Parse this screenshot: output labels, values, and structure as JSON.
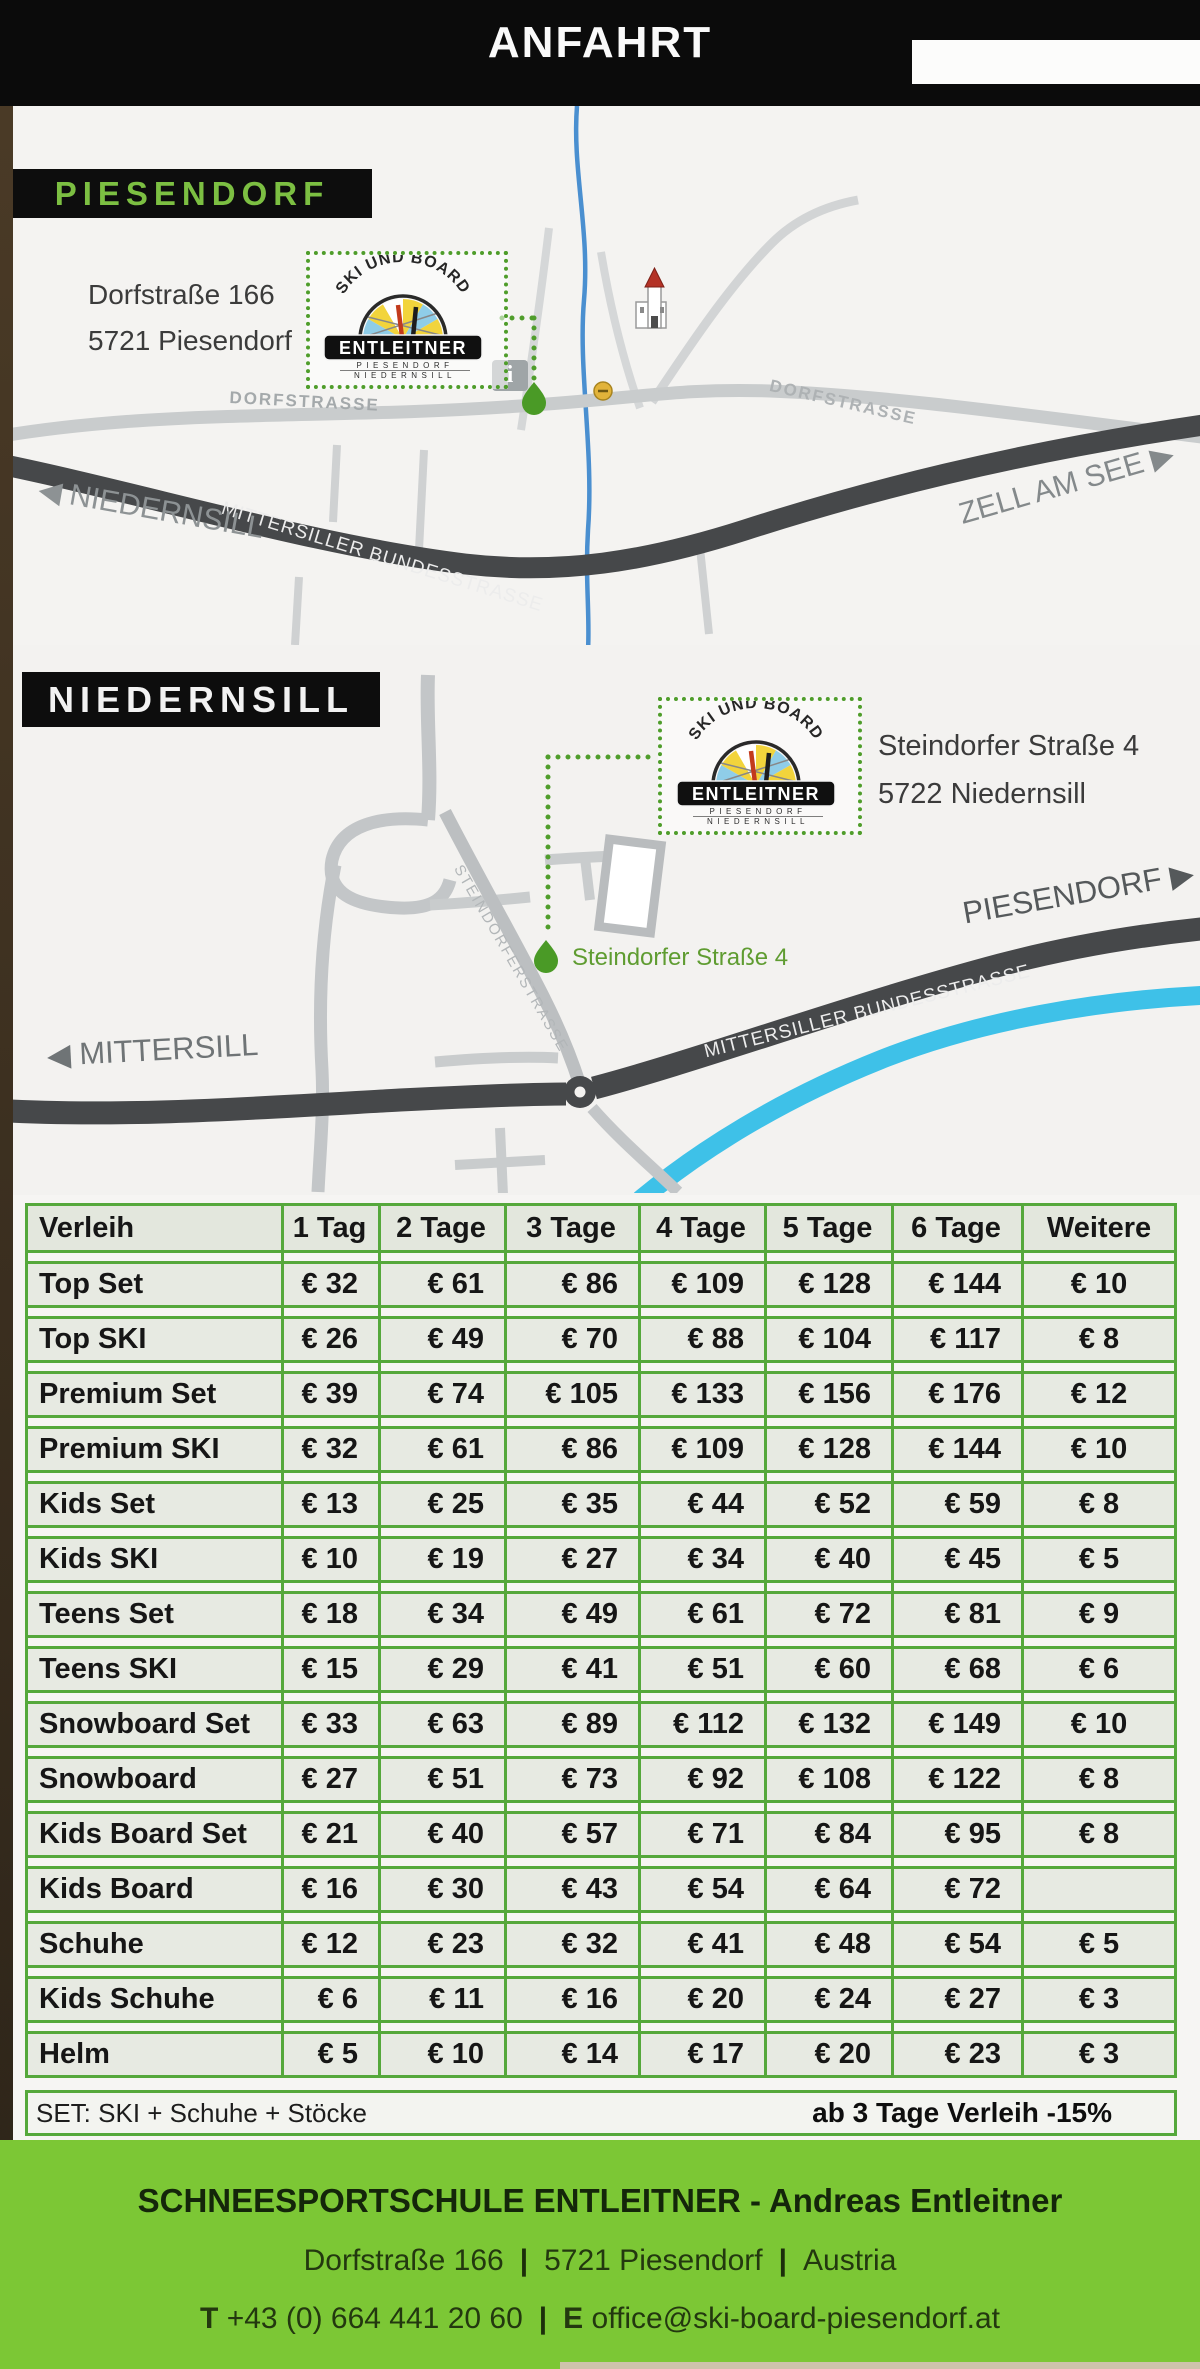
{
  "header": {
    "title": "ANFAHRT"
  },
  "logo": {
    "arc_text": "SKI UND BOARD",
    "name": "ENTLEITNER",
    "sub1": "PIESENDORF",
    "sub2": "NIEDERNSILL"
  },
  "map_piesendorf": {
    "section_label": "PIESENDORF",
    "address_line1": "Dorfstraße 166",
    "address_line2": "5721 Piesendorf",
    "road_dorfstrasse_left": "DORFSTRASSE",
    "road_dorfstrasse_right": "DORFSTRASSE",
    "road_bundesstrasse": "MITTERSILLER BUNDESSTRASSE",
    "direction_west": "◀ NIEDERNSILL",
    "direction_east": "ZELL AM SEE ▶",
    "info_icon_glyph": "i"
  },
  "map_niedernsill": {
    "section_label": "NIEDERNSILL",
    "address_line1": "Steindorfer Straße 4",
    "address_line2": "5722 Niedernsill",
    "marker_label": "Steindorfer Straße 4",
    "road_steindorferstrasse": "STEINDORFERSTRASSE",
    "road_bundesstrasse": "MITTERSILLER BUNDESSTRASSE",
    "direction_west": "◀ MITTERSILL",
    "direction_east": "PIESENDORF ▶"
  },
  "price_table": {
    "columns": [
      "Verleih",
      "1 Tag",
      "2 Tage",
      "3 Tage",
      "4 Tage",
      "5 Tage",
      "6 Tage",
      "Weitere"
    ],
    "rows": [
      {
        "label": "Top Set",
        "prices": [
          "€ 32",
          "€ 61",
          "€ 86",
          "€ 109",
          "€ 128",
          "€ 144",
          "€ 10"
        ]
      },
      {
        "label": "Top SKI",
        "prices": [
          "€ 26",
          "€ 49",
          "€ 70",
          "€ 88",
          "€ 104",
          "€ 117",
          "€ 8"
        ]
      },
      {
        "label": "Premium Set",
        "prices": [
          "€ 39",
          "€ 74",
          "€ 105",
          "€ 133",
          "€ 156",
          "€ 176",
          "€ 12"
        ]
      },
      {
        "label": "Premium SKI",
        "prices": [
          "€ 32",
          "€ 61",
          "€ 86",
          "€ 109",
          "€ 128",
          "€ 144",
          "€ 10"
        ]
      },
      {
        "label": "Kids Set",
        "prices": [
          "€ 13",
          "€ 25",
          "€ 35",
          "€ 44",
          "€ 52",
          "€ 59",
          "€ 8"
        ]
      },
      {
        "label": "Kids SKI",
        "prices": [
          "€ 10",
          "€ 19",
          "€ 27",
          "€ 34",
          "€ 40",
          "€ 45",
          "€ 5"
        ]
      },
      {
        "label": "Teens Set",
        "prices": [
          "€ 18",
          "€ 34",
          "€ 49",
          "€ 61",
          "€ 72",
          "€ 81",
          "€ 9"
        ]
      },
      {
        "label": "Teens SKI",
        "prices": [
          "€ 15",
          "€ 29",
          "€ 41",
          "€ 51",
          "€ 60",
          "€ 68",
          "€ 6"
        ]
      },
      {
        "label": "Snowboard Set",
        "prices": [
          "€ 33",
          "€ 63",
          "€ 89",
          "€ 112",
          "€ 132",
          "€ 149",
          "€ 10"
        ]
      },
      {
        "label": "Snowboard",
        "prices": [
          "€ 27",
          "€ 51",
          "€ 73",
          "€ 92",
          "€ 108",
          "€ 122",
          "€ 8"
        ]
      },
      {
        "label": "Kids Board Set",
        "prices": [
          "€ 21",
          "€ 40",
          "€ 57",
          "€ 71",
          "€ 84",
          "€ 95",
          "€ 8"
        ]
      },
      {
        "label": "Kids Board",
        "prices": [
          "€ 16",
          "€ 30",
          "€ 43",
          "€ 54",
          "€ 64",
          "€ 72",
          ""
        ]
      },
      {
        "label": "Schuhe",
        "prices": [
          "€ 12",
          "€ 23",
          "€ 32",
          "€ 41",
          "€ 48",
          "€ 54",
          "€ 5"
        ]
      },
      {
        "label": "Kids Schuhe",
        "prices": [
          "€ 6",
          "€ 11",
          "€ 16",
          "€ 20",
          "€ 24",
          "€ 27",
          "€ 3"
        ]
      },
      {
        "label": "Helm",
        "prices": [
          "€ 5",
          "€ 10",
          "€ 14",
          "€ 17",
          "€ 20",
          "€ 23",
          "€ 3"
        ]
      }
    ],
    "footnote_left": "SET: SKI + Schuhe + Stöcke",
    "footnote_right": "ab 3 Tage Verleih -15%"
  },
  "footer": {
    "line1": "SCHNEESPORTSCHULE ENTLEITNER - Andreas Entleitner",
    "address_part1": "Dorfstraße 166",
    "address_part2": "5721 Piesendorf",
    "address_part3": "Austria",
    "separator": "|",
    "phone_label": "T",
    "phone": "+43 (0) 664 441 20 60",
    "email_label": "E",
    "email": "office@ski-board-piesendorf.at"
  },
  "colors": {
    "footer_green": "#7cc735",
    "table_border_green": "#55a83b",
    "marker_green": "#4a9a26",
    "logo_green_text": "#7cbf42"
  }
}
